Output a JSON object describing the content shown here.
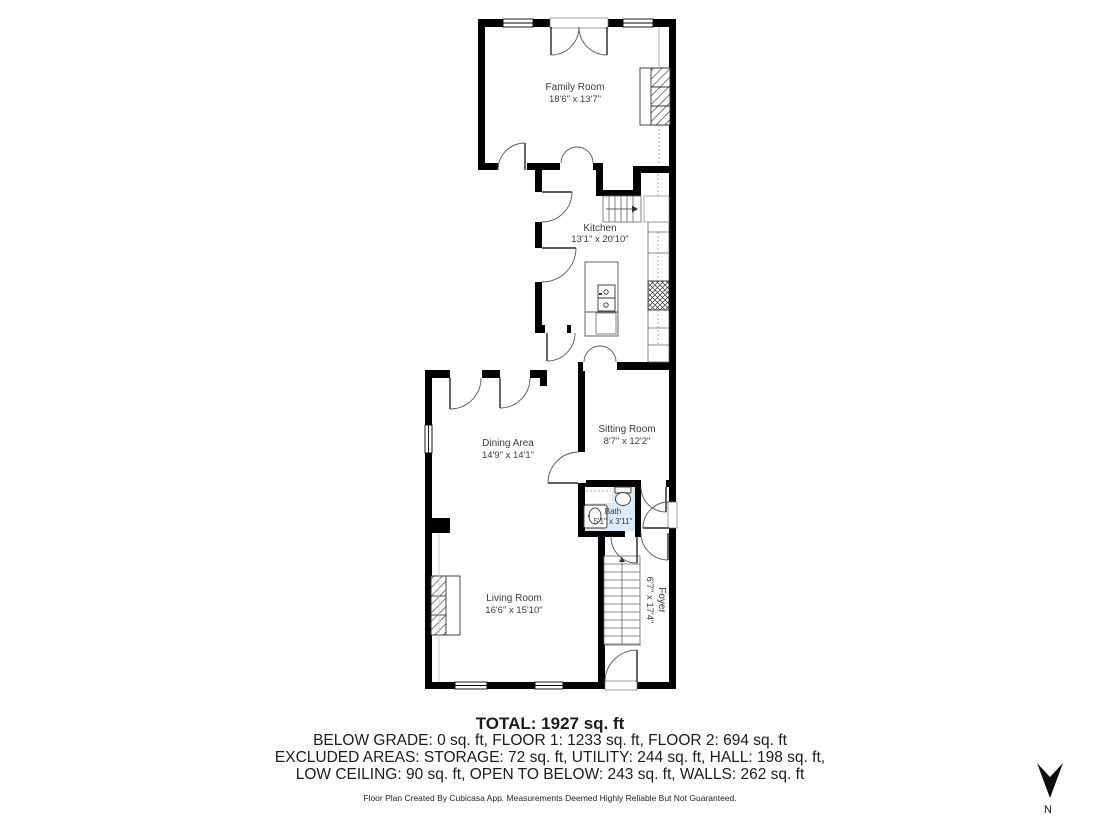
{
  "title": "Floor plan",
  "colors": {
    "wall": "#000000",
    "bath_fill": "#d9ecf7",
    "label_text": "#3b3b3b",
    "summary_text": "#1b1b1b"
  },
  "rooms": {
    "family": {
      "name": "Family Room",
      "dims": "18'6\" x 13'7\""
    },
    "kitchen": {
      "name": "Kitchen",
      "dims": "13'1\" x 20'10\""
    },
    "dining": {
      "name": "Dining Area",
      "dims": "14'9\" x 14'1\""
    },
    "sitting": {
      "name": "Sitting Room",
      "dims": "8'7\" x 12'2\""
    },
    "bath": {
      "name": "Bath",
      "dims": "5'1\" x 3'11\""
    },
    "living": {
      "name": "Living Room",
      "dims": "16'6\" x 15'10\""
    },
    "foyer": {
      "name": "Foyer",
      "dims": "6'7\" x 17'4\""
    }
  },
  "summary": {
    "total": "TOTAL: 1927 sq. ft",
    "floors": "BELOW GRADE: 0 sq. ft, FLOOR 1: 1233 sq. ft, FLOOR 2: 694 sq. ft",
    "excluded_1": "EXCLUDED AREAS: STORAGE: 72 sq. ft, UTILITY: 244 sq. ft, HALL: 198 sq. ft,",
    "excluded_2": "LOW CEILING: 90 sq. ft, OPEN TO BELOW: 243 sq. ft, WALLS: 262 sq. ft",
    "disclaimer": "Floor Plan Created By Cubicasa App. Measurements Deemed Highly Reliable But Not Guaranteed."
  },
  "compass": {
    "label": "N"
  }
}
